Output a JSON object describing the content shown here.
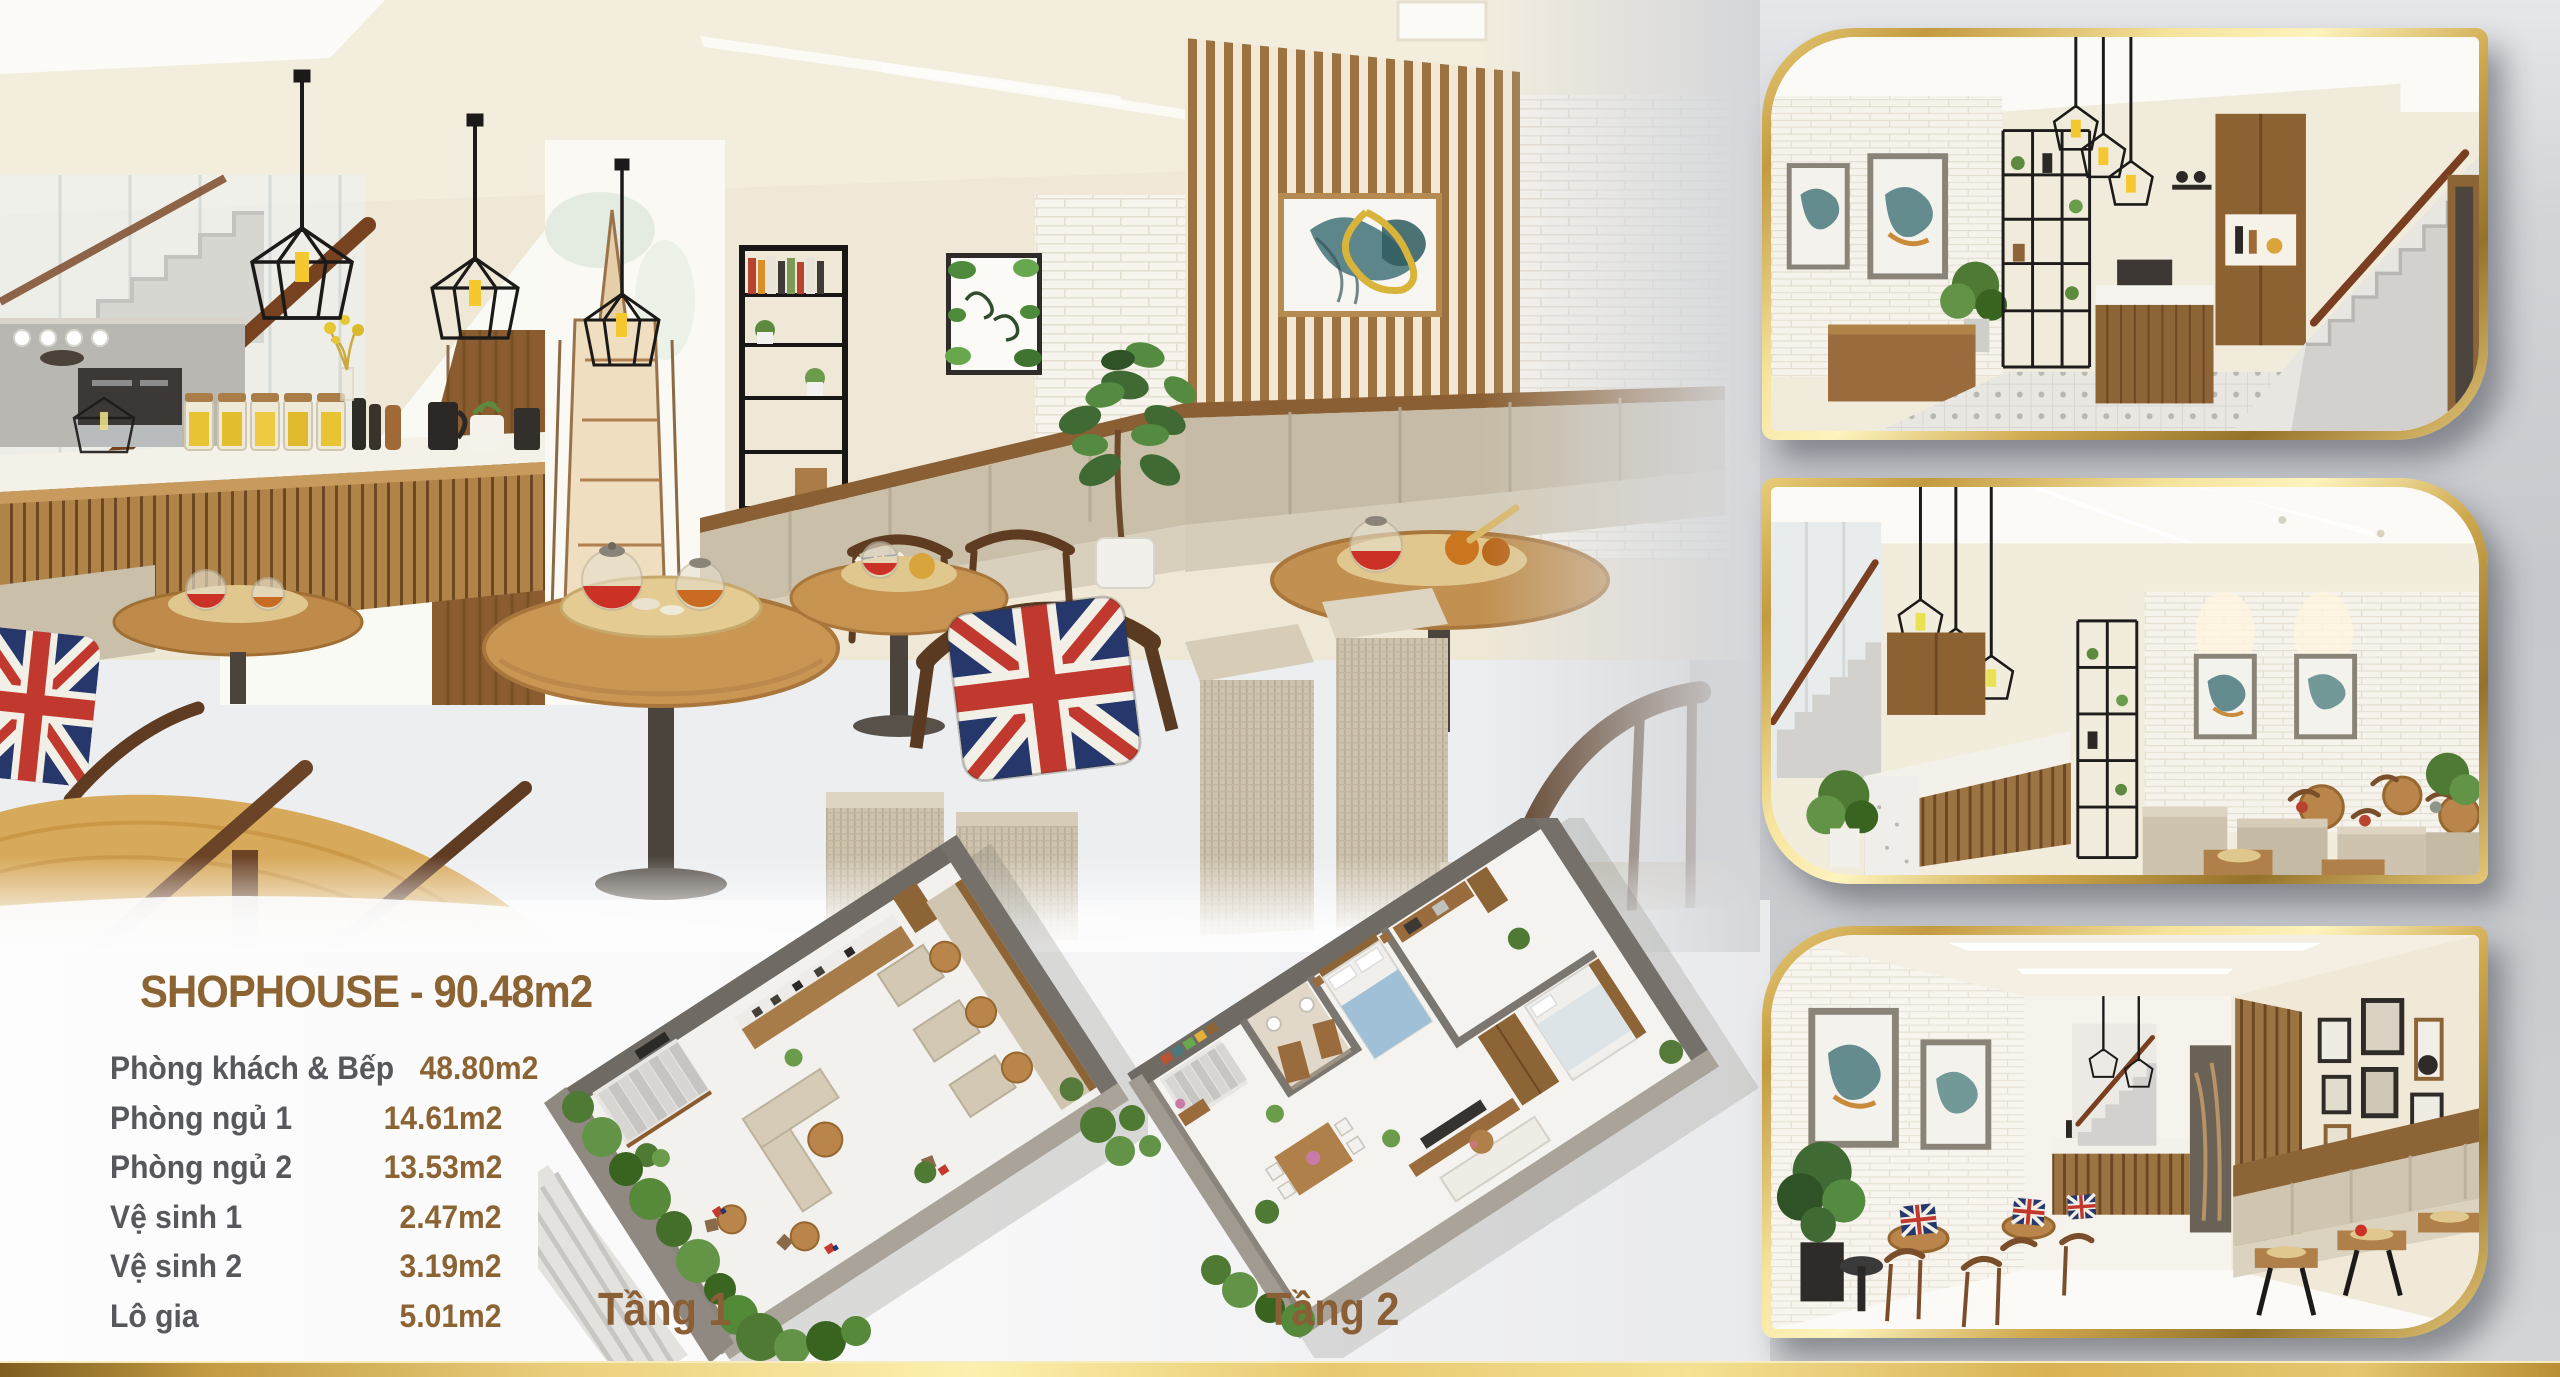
{
  "page": {
    "background_left": "#fdfdfd",
    "background_right": "#c7c9cd",
    "accent_gold": "#d9ab4f",
    "gold_bar_colors": [
      "#7e5d20",
      "#ebcf7c",
      "#fdf0ae",
      "#d9b254",
      "#b98f35"
    ]
  },
  "specs": {
    "title": "SHOPHOUSE - 90.48m2",
    "title_color": "#8c6434",
    "label_color": "#57585c",
    "value_color": "#8c6434",
    "rooms": [
      {
        "label": "Phòng khách & Bếp",
        "value": "48.80m2"
      },
      {
        "label": "Phòng ngủ 1",
        "value": "14.61m2"
      },
      {
        "label": "Phòng ngủ 2",
        "value": "13.53m2"
      },
      {
        "label": "Vệ sinh 1",
        "value": "2.47m2"
      },
      {
        "label": "Vệ sinh 2",
        "value": "3.19m2"
      },
      {
        "label": "Lô gia",
        "value": "5.01m2"
      }
    ]
  },
  "floorplans": [
    {
      "label": "Tầng 1"
    },
    {
      "label": "Tầng 2"
    }
  ]
}
